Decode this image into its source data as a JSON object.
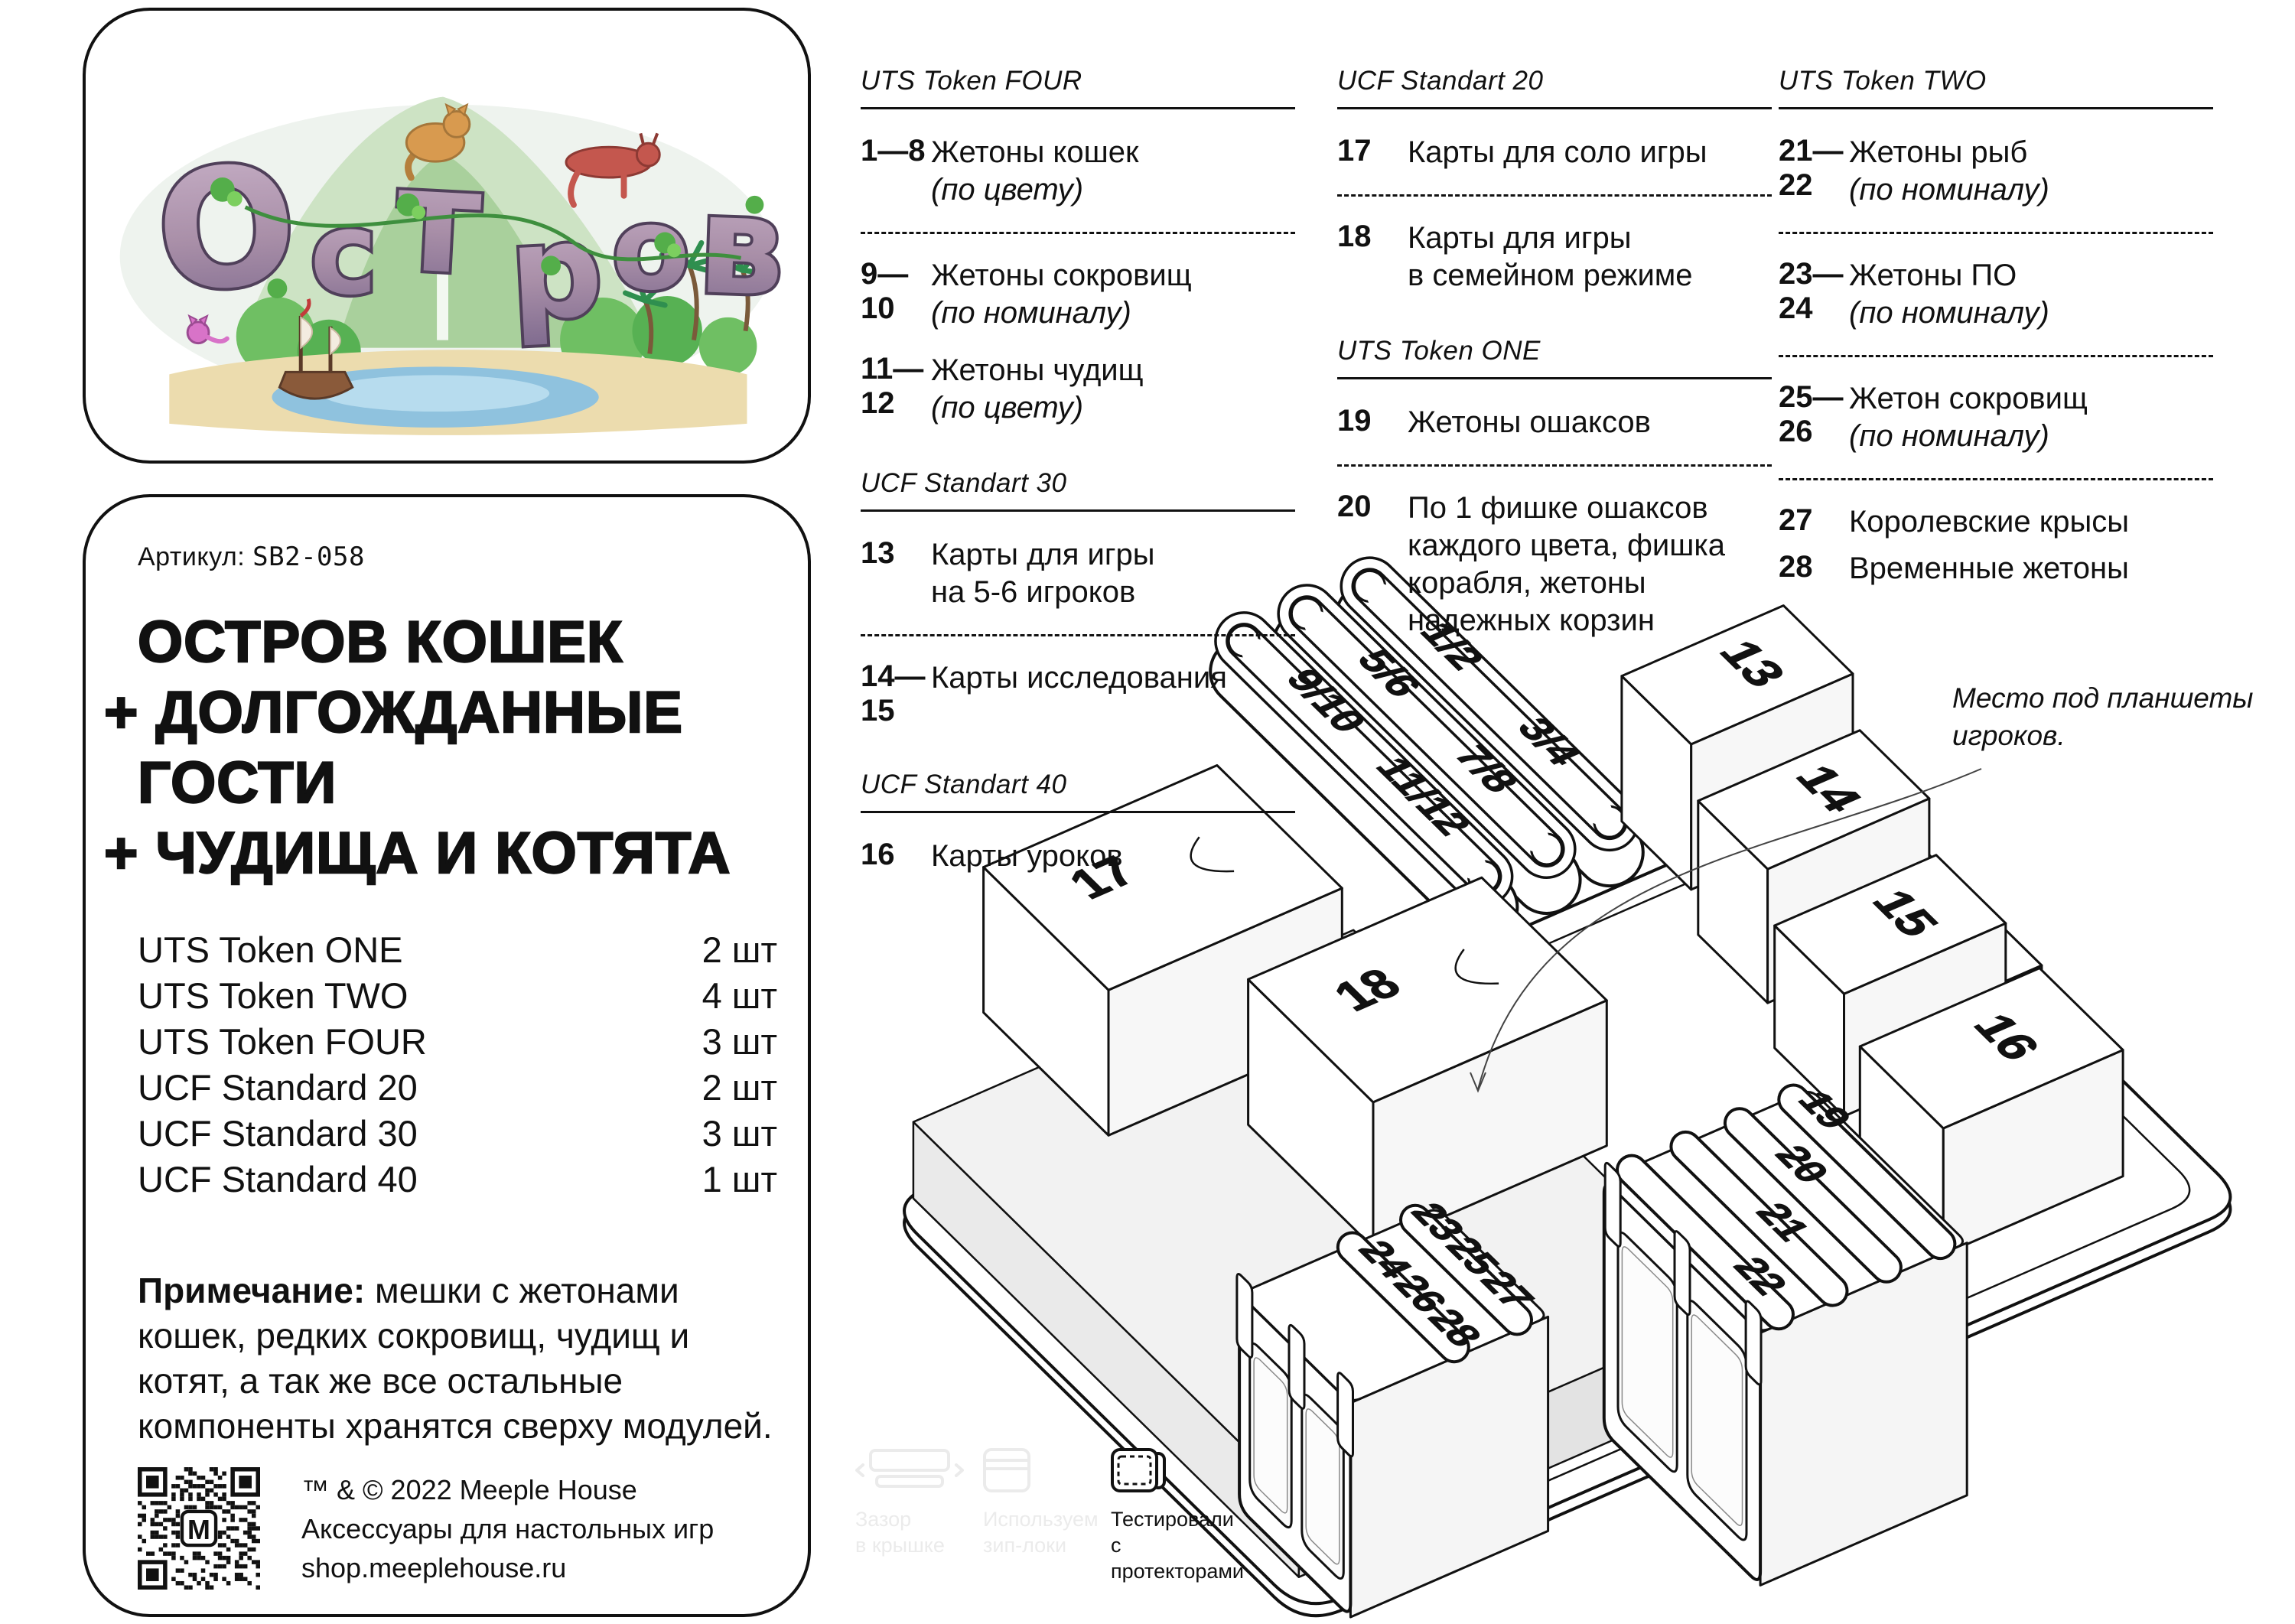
{
  "logo_card": {
    "letters": [
      "О",
      "с",
      "т",
      "р",
      "о",
      "в"
    ]
  },
  "info_card": {
    "article_label": "Артикул:",
    "article_value": "SB2-058",
    "title_line1": "ОСТРОВ КОШЕК",
    "title_line2": "+ ДОЛГОЖДАННЫЕ",
    "title_line3": "ГОСТИ",
    "title_line4": "+ ЧУДИЩА И КОТЯТА",
    "components": [
      {
        "name": "UTS Token ONE",
        "qty": "2 шт"
      },
      {
        "name": "UTS Token TWO",
        "qty": "4 шт"
      },
      {
        "name": "UTS Token FOUR",
        "qty": "3 шт"
      },
      {
        "name": "UCF Standard 20",
        "qty": "2 шт"
      },
      {
        "name": "UCF Standard 30",
        "qty": "3 шт"
      },
      {
        "name": "UCF Standard 40",
        "qty": "1 шт"
      }
    ],
    "note_label": "Примечание:",
    "note_text": "мешки с жетонами кошек, редких сокровищ, чудищ и котят, а так же все остальные компоненты хранятся сверху модулей.",
    "copyright_line1": "™ & © 2022 Meeple House",
    "copyright_line2": "Аксессуары для настольных игр",
    "copyright_line3": "shop.meeplehouse.ru"
  },
  "columns": [
    {
      "header": "UTS Token FOUR",
      "items": [
        {
          "num": "1—8",
          "l1": "Жетоны кошек",
          "l2": "(по цвету)"
        },
        {
          "num": "9—10",
          "l1": "Жетоны сокровищ",
          "l2": "(по номиналу)"
        },
        {
          "num": "11—12",
          "l1": "Жетоны чудищ",
          "l2": "(по цвету)"
        }
      ],
      "header2": "UCF Standart 30",
      "items2": [
        {
          "num": "13",
          "l1": "Карты для игры",
          "l2": "на 5-6 игроков"
        },
        {
          "num": "14—15",
          "l1": "Карты исследования"
        }
      ],
      "header3": "UCF Standart 40",
      "items3": [
        {
          "num": "16",
          "l1": "Карты уроков"
        }
      ]
    },
    {
      "header": "UCF Standart 20",
      "items": [
        {
          "num": "17",
          "l1": "Карты для соло игры"
        },
        {
          "num": "18",
          "l1": "Карты для игры",
          "l2": "в семейном режиме"
        }
      ],
      "header2": "UTS Token ONE",
      "items2": [
        {
          "num": "19",
          "l1": "Жетоны ошаксов"
        },
        {
          "num": "20",
          "l1": "По 1 фишке ошаксов",
          "l2": "каждого цвета, фишка",
          "l3": "корабля, жетоны",
          "l4": "надежных корзин"
        }
      ]
    },
    {
      "header": "UTS Token TWO",
      "items": [
        {
          "num": "21—22",
          "l1": "Жетоны рыб",
          "l2": "(по номиналу)"
        },
        {
          "num": "23—24",
          "l1": "Жетоны ПО",
          "l2": "(по номиналу)"
        },
        {
          "num": "25—26",
          "l1": "Жетон сокровищ",
          "l2": "(по номиналу)"
        },
        {
          "num": "27",
          "l1": "Королевские крысы"
        },
        {
          "num": "28",
          "l1": "Временные жетоны"
        }
      ]
    }
  ],
  "diagram": {
    "annotation_line1": "Место под планшеты",
    "annotation_line2": "игроков.",
    "token_trays": [
      [
        "1/2",
        "3/4"
      ],
      [
        "5/6",
        "7/8"
      ],
      [
        "9/10",
        "11/12"
      ]
    ],
    "card_trays": [
      "13",
      "14",
      "15",
      "16"
    ],
    "big_trays": [
      "17",
      "18"
    ],
    "right_box": [
      "19",
      "20",
      "21",
      "22"
    ],
    "left_box_back": [
      "23",
      "25",
      "27"
    ],
    "left_box_front": [
      "24",
      "26",
      "28"
    ]
  },
  "footer": {
    "icons": [
      {
        "l1": "Зазор",
        "l2": "в крышке"
      },
      {
        "l1": "Используем",
        "l2": "зип-локи"
      },
      {
        "l1": "Тестировали",
        "l2": "с протекторами"
      }
    ]
  }
}
